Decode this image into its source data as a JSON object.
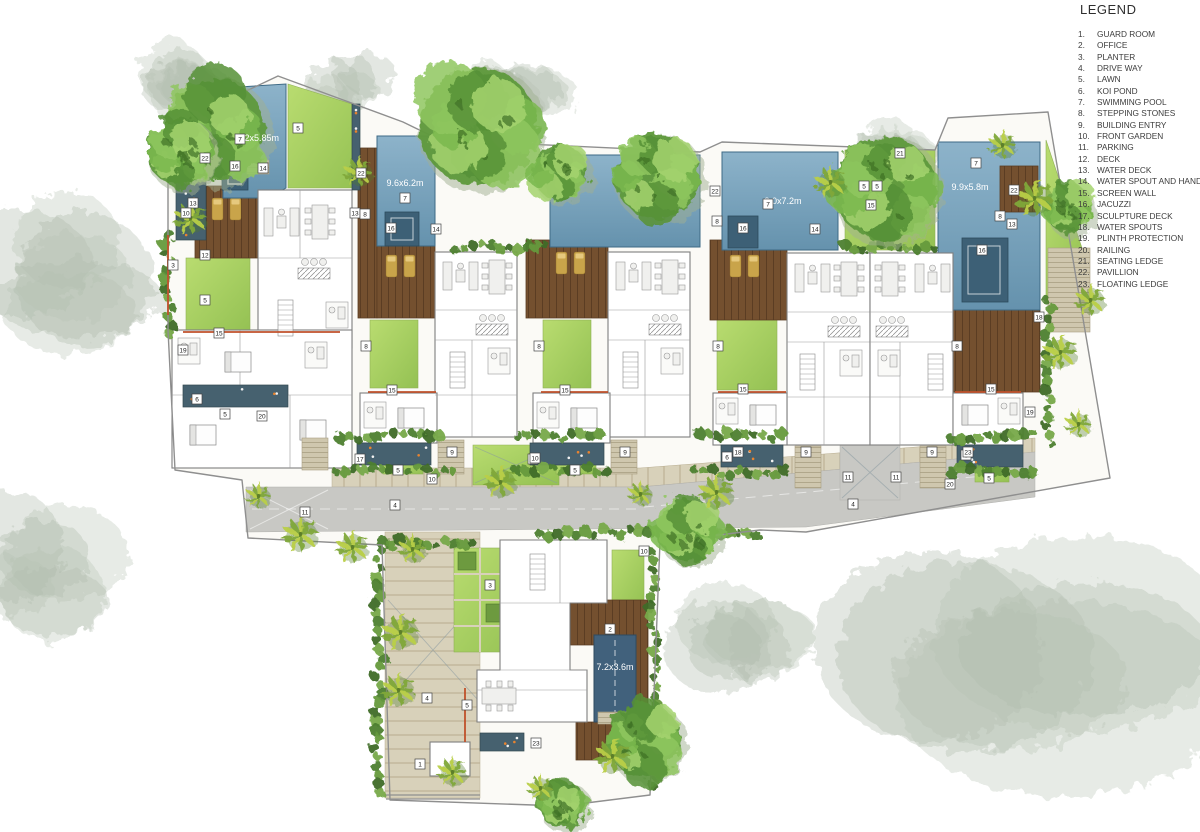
{
  "legend": {
    "title": "LEGEND",
    "items": [
      {
        "num": "1.",
        "label": "GUARD ROOM"
      },
      {
        "num": "2.",
        "label": "OFFICE"
      },
      {
        "num": "3.",
        "label": "PLANTER"
      },
      {
        "num": "4.",
        "label": "DRIVE WAY"
      },
      {
        "num": "5.",
        "label": "LAWN"
      },
      {
        "num": "6.",
        "label": "KOI POND"
      },
      {
        "num": "7.",
        "label": "SWIMMING POOL"
      },
      {
        "num": "8.",
        "label": "STEPPING STONES"
      },
      {
        "num": "9.",
        "label": "BUILDING ENTRY"
      },
      {
        "num": "10.",
        "label": "FRONT GARDEN"
      },
      {
        "num": "11.",
        "label": "PARKING"
      },
      {
        "num": "12.",
        "label": "DECK"
      },
      {
        "num": "13.",
        "label": "WATER DECK"
      },
      {
        "num": "14.",
        "label": "WATER SPOUT AND HAND RAIL"
      },
      {
        "num": "15.",
        "label": "SCREEN WALL"
      },
      {
        "num": "16.",
        "label": "JACUZZI"
      },
      {
        "num": "17.",
        "label": "SCULPTURE DECK"
      },
      {
        "num": "18.",
        "label": "WATER SPOUTS"
      },
      {
        "num": "19.",
        "label": "PLINTH PROTECTION"
      },
      {
        "num": "20.",
        "label": "RAILING"
      },
      {
        "num": "21.",
        "label": "SEATING LEDGE"
      },
      {
        "num": "22.",
        "label": "PAVILLION"
      },
      {
        "num": "23.",
        "label": "FLOATING LEDGE"
      }
    ]
  },
  "plan": {
    "pool_labels": [
      {
        "text": "7.2x5.85m",
        "x": 258,
        "y": 141
      },
      {
        "text": "9.6x6.2m",
        "x": 405,
        "y": 186
      },
      {
        "text": "9.0x7.2m",
        "x": 783,
        "y": 204
      },
      {
        "text": "9.9x5.8m",
        "x": 970,
        "y": 190
      },
      {
        "text": "7.2x3.6m",
        "x": 615,
        "y": 670
      }
    ],
    "markers": [
      [
        7,
        240,
        139
      ],
      [
        7,
        405,
        198
      ],
      [
        7,
        768,
        204
      ],
      [
        7,
        976,
        163
      ],
      [
        16,
        235,
        166
      ],
      [
        16,
        391,
        228
      ],
      [
        16,
        743,
        228
      ],
      [
        16,
        982,
        250
      ],
      [
        22,
        205,
        158
      ],
      [
        22,
        361,
        173
      ],
      [
        22,
        715,
        191
      ],
      [
        22,
        1014,
        190
      ],
      [
        13,
        193,
        203
      ],
      [
        13,
        355,
        213
      ],
      [
        13,
        1012,
        224
      ],
      [
        8,
        365,
        214
      ],
      [
        8,
        717,
        221
      ],
      [
        8,
        1000,
        216
      ],
      [
        8,
        366,
        346
      ],
      [
        8,
        539,
        346
      ],
      [
        8,
        718,
        346
      ],
      [
        8,
        957,
        346
      ],
      [
        14,
        263,
        168
      ],
      [
        14,
        436,
        229
      ],
      [
        14,
        815,
        229
      ],
      [
        5,
        298,
        128
      ],
      [
        5,
        205,
        300
      ],
      [
        5,
        398,
        470
      ],
      [
        5,
        575,
        470
      ],
      [
        5,
        864,
        186
      ],
      [
        5,
        877,
        186
      ],
      [
        5,
        225,
        414
      ],
      [
        5,
        467,
        705
      ],
      [
        5,
        989,
        478
      ],
      [
        15,
        219,
        333
      ],
      [
        15,
        871,
        205
      ],
      [
        15,
        392,
        390
      ],
      [
        15,
        565,
        390
      ],
      [
        15,
        743,
        389
      ],
      [
        15,
        991,
        389
      ],
      [
        6,
        197,
        399
      ],
      [
        6,
        727,
        457
      ],
      [
        6,
        966,
        455
      ],
      [
        17,
        360,
        459
      ],
      [
        17,
        533,
        459
      ],
      [
        18,
        738,
        452
      ],
      [
        18,
        1039,
        317
      ],
      [
        23,
        968,
        452
      ],
      [
        23,
        536,
        743
      ],
      [
        9,
        452,
        452
      ],
      [
        9,
        625,
        452
      ],
      [
        9,
        806,
        452
      ],
      [
        9,
        932,
        452
      ],
      [
        10,
        432,
        479
      ],
      [
        10,
        535,
        458
      ],
      [
        10,
        186,
        213
      ],
      [
        10,
        644,
        551
      ],
      [
        11,
        305,
        512
      ],
      [
        11,
        848,
        477
      ],
      [
        11,
        896,
        477
      ],
      [
        4,
        395,
        505
      ],
      [
        4,
        853,
        504
      ],
      [
        4,
        427,
        698
      ],
      [
        12,
        205,
        255
      ],
      [
        19,
        183,
        350
      ],
      [
        19,
        1030,
        412
      ],
      [
        20,
        262,
        416
      ],
      [
        20,
        950,
        484
      ],
      [
        21,
        900,
        153
      ],
      [
        1,
        420,
        764
      ],
      [
        2,
        610,
        629
      ],
      [
        3,
        490,
        585
      ],
      [
        3,
        173,
        265
      ]
    ]
  },
  "scene": {
    "colors": {
      "pool": "#7fa8c0",
      "lawn": "#a8cf62",
      "deck": "#74502f",
      "road": "#c8c8c4",
      "koi_pond": "#46616f",
      "paving": "#d8d1ba",
      "tree": "#6fae49",
      "palm": "#b9cf48",
      "accent_orange": "#c0512b"
    },
    "gray_trees": [
      [
        58,
        272,
        108,
        95
      ],
      [
        36,
        572,
        80,
        72
      ],
      [
        182,
        80,
        52,
        42
      ],
      [
        985,
        695,
        225,
        135
      ],
      [
        730,
        640,
        70,
        58
      ],
      [
        508,
        100,
        66,
        40
      ],
      [
        906,
        152,
        50,
        34
      ],
      [
        348,
        88,
        48,
        32
      ]
    ],
    "canopy_trees": [
      [
        215,
        130,
        55
      ],
      [
        180,
        152,
        36
      ],
      [
        478,
        126,
        64
      ],
      [
        560,
        172,
        30
      ],
      [
        657,
        176,
        46
      ],
      [
        884,
        188,
        56
      ],
      [
        688,
        531,
        33
      ],
      [
        644,
        740,
        40
      ],
      [
        1068,
        208,
        26
      ],
      [
        562,
        804,
        26
      ]
    ],
    "palm_trees": [
      [
        190,
        218
      ],
      [
        358,
        172
      ],
      [
        258,
        496
      ],
      [
        300,
        534
      ],
      [
        352,
        547
      ],
      [
        412,
        549
      ],
      [
        640,
        494
      ],
      [
        716,
        492
      ],
      [
        830,
        182
      ],
      [
        1002,
        145
      ],
      [
        1034,
        198
      ],
      [
        1060,
        352
      ],
      [
        1090,
        300
      ],
      [
        1078,
        424
      ],
      [
        400,
        632
      ],
      [
        398,
        690
      ],
      [
        452,
        772
      ],
      [
        540,
        788
      ],
      [
        612,
        756
      ],
      [
        500,
        482
      ]
    ],
    "shrub_strips": [
      [
        340,
        436,
        100,
        0
      ],
      [
        518,
        436,
        88,
        0
      ],
      [
        700,
        436,
        88,
        0
      ],
      [
        952,
        436,
        86,
        0
      ],
      [
        336,
        470,
        118,
        0
      ],
      [
        516,
        470,
        96,
        0
      ],
      [
        694,
        472,
        92,
        0
      ],
      [
        952,
        470,
        82,
        0
      ],
      [
        540,
        533,
        224,
        0
      ],
      [
        382,
        543,
        96,
        0
      ],
      [
        654,
        552,
        0,
        238
      ],
      [
        378,
        550,
        0,
        244
      ],
      [
        168,
        235,
        0,
        100
      ],
      [
        1048,
        300,
        0,
        150
      ],
      [
        845,
        248,
        90,
        0
      ],
      [
        455,
        248,
        95,
        0
      ]
    ],
    "koi_ponds": [
      [
        357,
        443,
        74,
        22
      ],
      [
        530,
        443,
        74,
        22
      ],
      [
        721,
        445,
        62,
        22
      ],
      [
        957,
        445,
        66,
        22
      ],
      [
        183,
        385,
        105,
        22
      ],
      [
        480,
        733,
        44,
        18
      ],
      [
        176,
        180,
        30,
        60
      ],
      [
        352,
        104,
        8,
        86
      ]
    ]
  }
}
